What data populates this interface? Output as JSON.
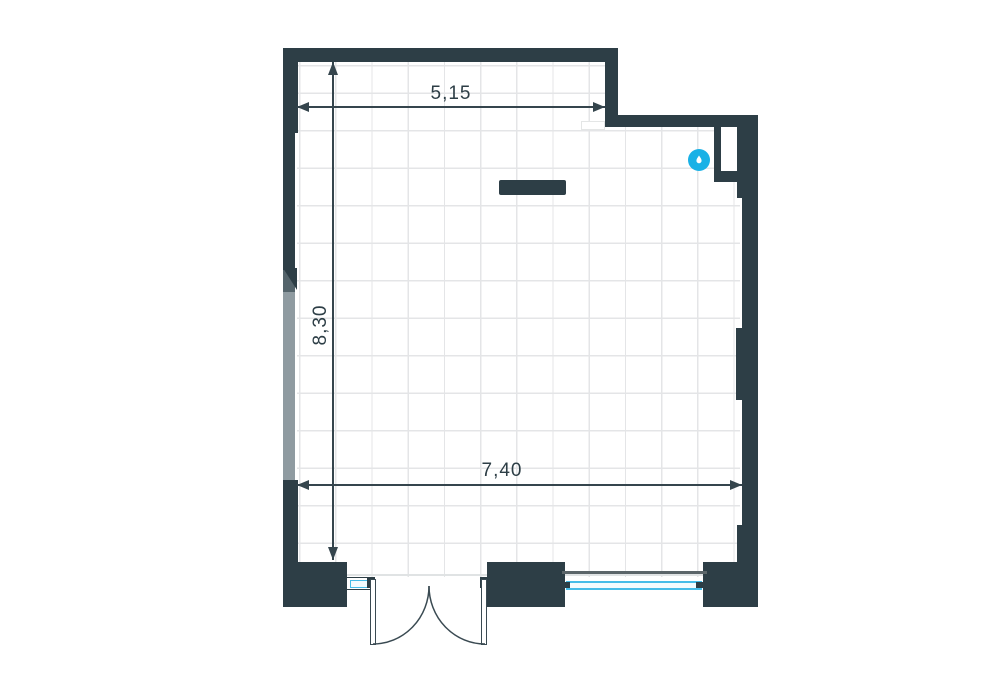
{
  "plan": {
    "type": "floor-plan",
    "dimensions": {
      "top_width": "5,15",
      "left_height": "8,30",
      "bottom_width": "7,40"
    },
    "markers": [
      {
        "name": "water-drop-icon"
      }
    ],
    "colors": {
      "wall": "#2d3e46",
      "dim": "#35454d",
      "dim_text": "#2d3e46",
      "wall_gray_medium": "#54646b",
      "wall_gray_light": "#8f9ba1",
      "grid": "#e4e5e7",
      "face_line": "#e0e3e4",
      "sill_line": "#5b6569",
      "glass": "#45bce8",
      "glass_fill": "#f2fbfe",
      "marker": "#19b1e6"
    }
  }
}
